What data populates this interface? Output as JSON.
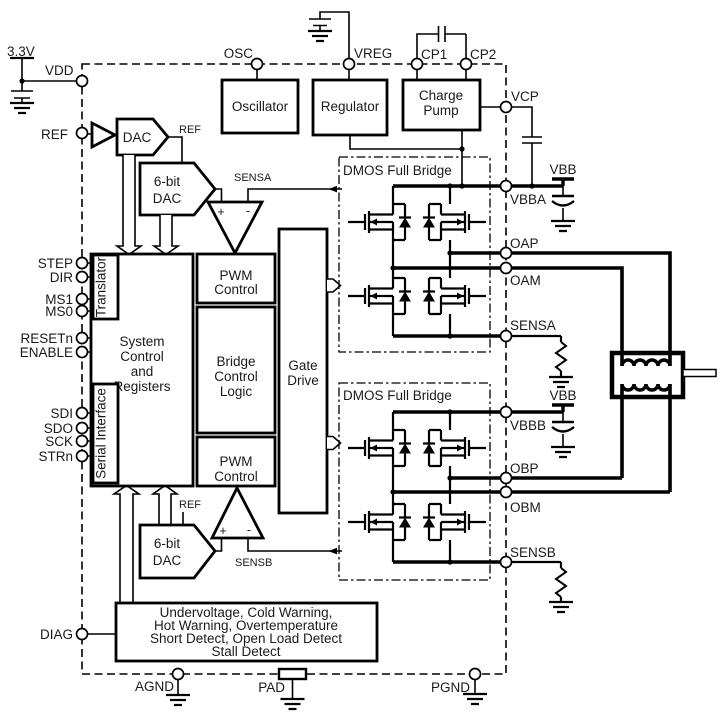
{
  "supply": {
    "v33": "3.3V",
    "vbb": "VBB"
  },
  "pins": {
    "left": [
      "VDD",
      "REF",
      "STEP",
      "DIR",
      "MS1",
      "MS0",
      "RESETn",
      "ENABLE",
      "SDI",
      "SDO",
      "SCK",
      "STRn",
      "DIAG"
    ],
    "top": [
      "OSC",
      "VREG",
      "CP1",
      "CP2"
    ],
    "right": [
      "VCP",
      "VBBA",
      "OAP",
      "OAM",
      "SENSA",
      "VBBB",
      "OBP",
      "OBM",
      "SENSB"
    ],
    "bottom": [
      "AGND",
      "PAD",
      "PGND"
    ]
  },
  "blocks": {
    "oscillator": "Oscillator",
    "regulator": "Regulator",
    "charge_pump": [
      "Charge",
      "Pump"
    ],
    "ref_dac": "DAC",
    "dac6": [
      "6-bit",
      "DAC"
    ],
    "translator": "Translator",
    "system": [
      "System",
      "Control",
      "and",
      "Registers"
    ],
    "serial_interface": "Serial Interface",
    "pwm": [
      "PWM",
      "Control"
    ],
    "bridge_logic": [
      "Bridge",
      "Control",
      "Logic"
    ],
    "gate_drive": [
      "Gate",
      "Drive"
    ],
    "dmos_bridge": "DMOS Full Bridge",
    "diagnostics": [
      "Undervoltage, Cold Warning,",
      "Hot Warning, Overtemperature",
      "Short Detect, Open Load Detect",
      "Stall Detect"
    ]
  },
  "nets": {
    "ref": "REF",
    "sensa": "SENSA",
    "sensb": "SENSB",
    "plus": "+",
    "minus": "-"
  }
}
